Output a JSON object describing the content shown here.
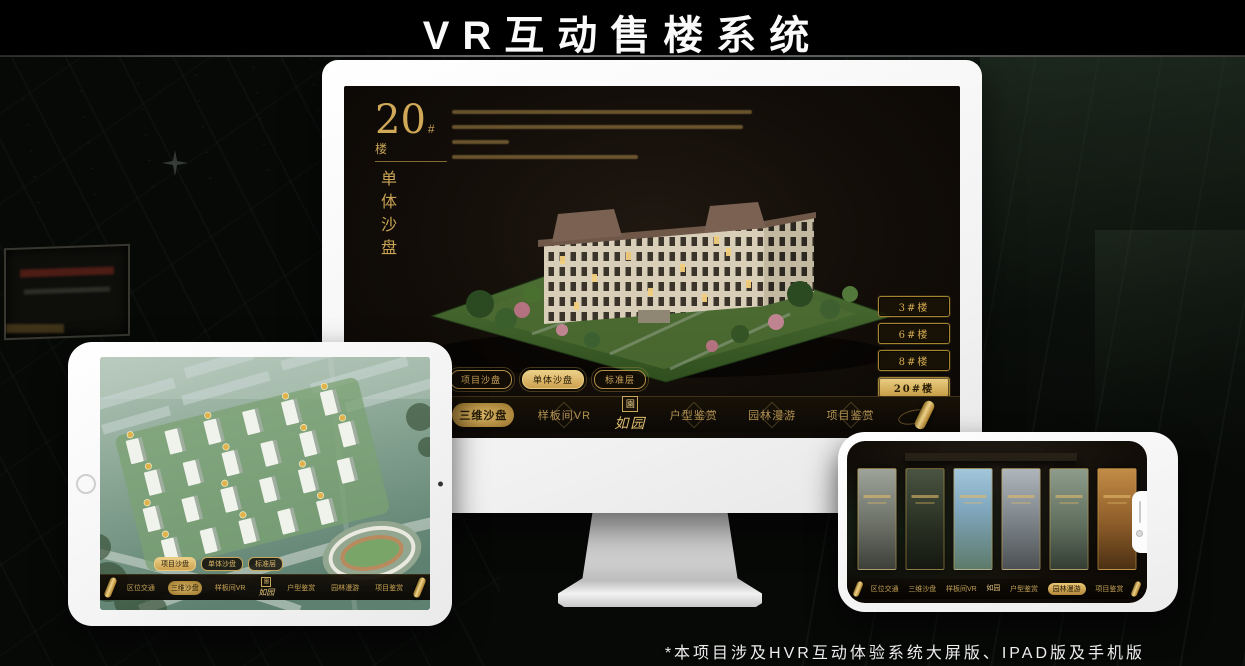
{
  "header": {
    "title": "VR互动售楼系统"
  },
  "footer": {
    "note": "*本项目涉及HVR互动体验系统大屏版、IPAD版及手机版"
  },
  "brand": {
    "logo_seal": "園",
    "logo_text": "如园"
  },
  "nav": {
    "items": [
      {
        "label": "区位交通"
      },
      {
        "label": "三维沙盘"
      },
      {
        "label": "样板间VR"
      },
      {
        "label": "户型鉴赏"
      },
      {
        "label": "园林漫游"
      },
      {
        "label": "项目鉴赏"
      }
    ]
  },
  "sub_tabs": [
    {
      "label": "项目沙盘"
    },
    {
      "label": "单体沙盘"
    },
    {
      "label": "标准层"
    }
  ],
  "monitor_screen": {
    "hero_number": "20",
    "hero_suffix": "#楼",
    "hero_vertical": "单体沙盘",
    "active_sub_tab": "单体沙盘",
    "active_nav_item": "三维沙盘",
    "building_buttons": [
      {
        "label": "3#楼",
        "active": false
      },
      {
        "label": "6#楼",
        "active": false
      },
      {
        "label": "8#楼",
        "active": false
      },
      {
        "label": "20#楼",
        "active": true
      }
    ]
  },
  "ipad_screen": {
    "active_sub_tab": "项目沙盘",
    "active_nav_item": "三维沙盘"
  },
  "phone_screen": {
    "active_nav_item": "园林漫游",
    "gallery_panel_count": 6
  },
  "colors": {
    "gold": "#d2a855",
    "gold_bright": "#ecd089",
    "screen_bg": "#13100a",
    "active_text": "#241a06"
  }
}
